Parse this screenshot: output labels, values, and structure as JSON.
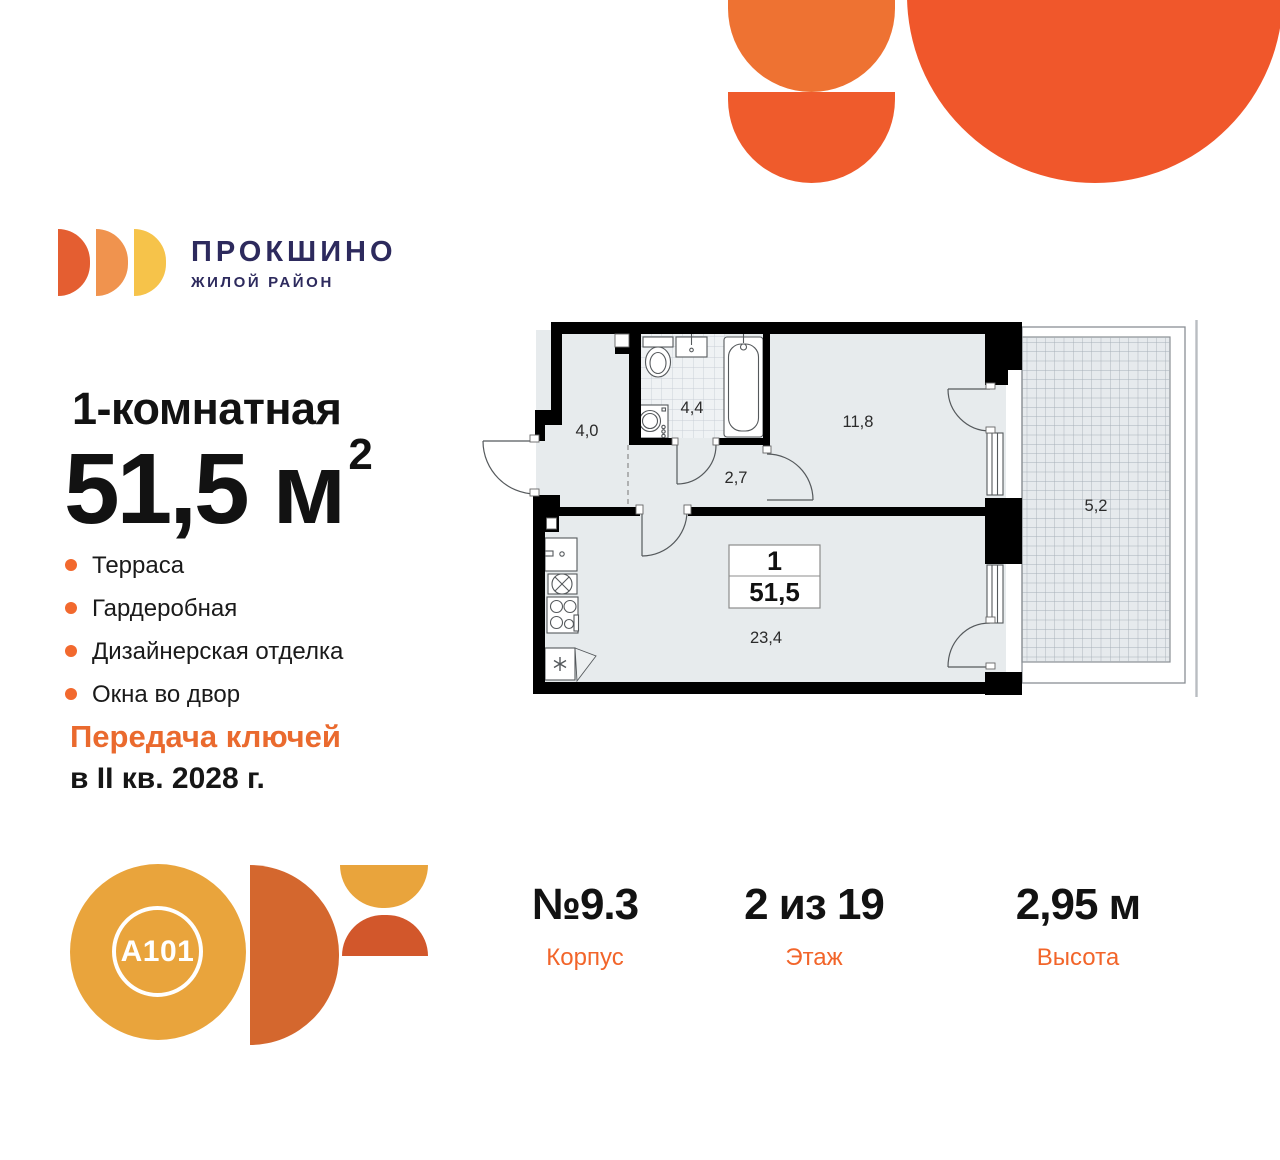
{
  "brand": {
    "name": "ПРОКШИНО",
    "tagline": "ЖИЛОЙ РАЙОН"
  },
  "listing": {
    "rooms_title": "1-комнатная",
    "area_value": "51,5",
    "area_unit": " м",
    "area_sup": "2",
    "features": [
      "Терраса",
      "Гардеробная",
      "Дизайнерская отделка",
      "Окна во двор"
    ],
    "handover_label": "Передача ключей",
    "handover_date": "в II кв. 2028 г."
  },
  "plan": {
    "rooms": {
      "hall": "4,0",
      "bath": "4,4",
      "corridor": "2,7",
      "bedroom": "11,8",
      "terrace": "5,2",
      "living": "23,4"
    },
    "badge": {
      "number": "1",
      "area": "51,5"
    }
  },
  "summary": {
    "items": [
      {
        "value": "№9.3",
        "label": "Корпус"
      },
      {
        "value": "2 из 19",
        "label": "Этаж"
      },
      {
        "value": "2,95 м",
        "label": "Высота"
      }
    ]
  },
  "developer": {
    "logo_text": "A101"
  },
  "palette": {
    "accent_orange": "#F2652A",
    "deco_orange": "#F0572B",
    "deco_orange_light": "#EE7232",
    "brand_navy": "#2D2A5D",
    "logo_gold": "#E9A43C",
    "logo_rust": "#D4672E",
    "room_fill": "#E7EBED",
    "wall_black": "#000000"
  }
}
